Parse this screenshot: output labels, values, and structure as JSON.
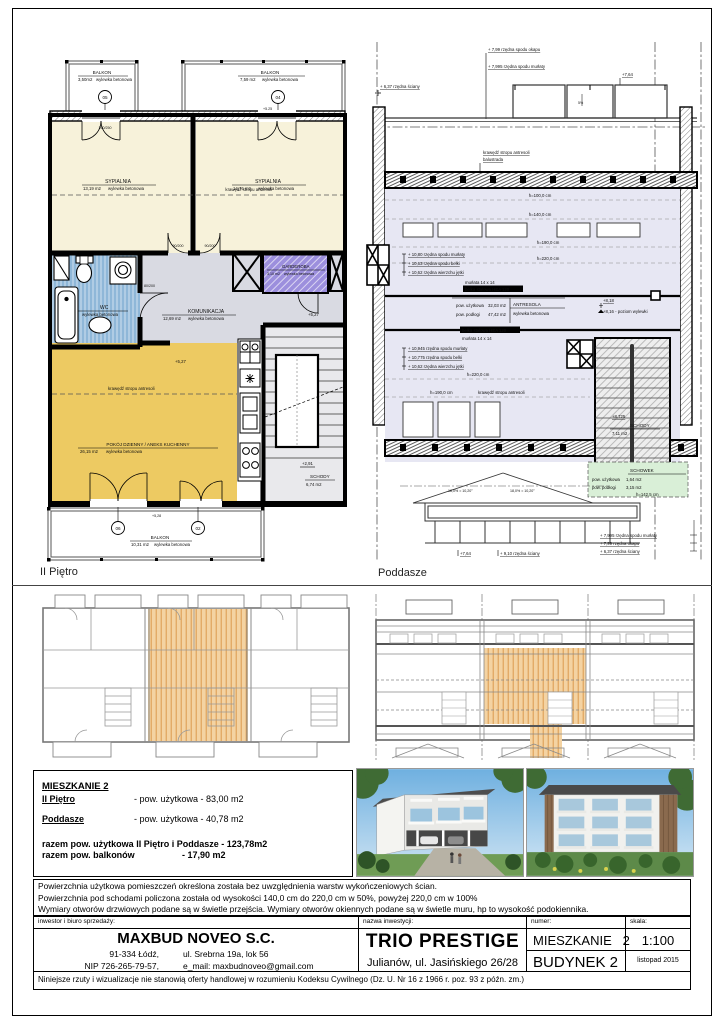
{
  "plans": {
    "left_title": "II Piętro",
    "right_title": "Poddasze"
  },
  "floor2": {
    "balkon05": {
      "name": "BALKON",
      "area": "3,50m2",
      "finish": "wylewka betonowa",
      "mark": "05"
    },
    "balkon04": {
      "name": "BALKON",
      "area": "7,59 m2",
      "finish": "wylewka betonowa",
      "mark": "04"
    },
    "sypialnia_l": {
      "name": "SYPIALNIA",
      "area": "13,19 m2",
      "finish": "wylewka betonowa"
    },
    "sypialnia_p": {
      "name": "SYPIALNIA",
      "area": "14,76 m2",
      "finish": "wylewka betonowa"
    },
    "wc": {
      "name": "WC",
      "area": "6,37 m2",
      "finish": "wylewka betonowa"
    },
    "komunikacja": {
      "name": "KOMUNIKACJA",
      "area": "12,69 m2",
      "finish": "wylewka betonowa"
    },
    "garderoba": {
      "name": "GARDEROBA",
      "area": "3,10 m2",
      "finish": "wylewka betonowa"
    },
    "pokoj": {
      "name": "POKÓJ DZIENNY / ANEKS KUCHENNY",
      "area": "26,15 m2",
      "finish": "wylewka betonowa"
    },
    "schody": {
      "name": "SCHODY",
      "area": "6,74 m2"
    },
    "balkon_dol": {
      "name": "BALKON",
      "area": "10,31 m2",
      "finish": "wylewka betonowa",
      "mark1": "06",
      "mark2": "02"
    },
    "level_527": "+5,27",
    "level_291": "+2,91",
    "level_525": "+5,25",
    "level_528": "+5,28",
    "edge_note": "krawędź stropu antresoli",
    "dim_wc_door": "80/200",
    "dim_bed_door": "90/200",
    "dim_window": "160/250"
  },
  "attic": {
    "wall_637": "+ 6,37 rzędna ściany",
    "okap_799": "+ 7,99 rzędna spodu okapu",
    "murlata_7995": "+ 7,995  rzędna  spodu murłaty",
    "level_764": "+7,64",
    "slope_5": "5%",
    "edge_note": "krawędź stropu antresoli",
    "balustrada": "balustrada",
    "h100": "h=100,0 cm",
    "h140": "h=140,0 cm",
    "h190": "h=190,0 cm",
    "h220": "h=220,0 cm",
    "murlata_1080": "+ 10,80  rzędna spodu murłaty",
    "belka_1063": "+ 10,63  rzędna spodu belki",
    "jetka_1062": "+ 10,62  rzędna wierzchu jętki",
    "murlata_14": "murłata 14 x 14",
    "belka_hea": "belka stalowa HEA 120",
    "antresola": {
      "name": "ANTRESOLA",
      "usable_label": "pow. użytkowa",
      "usable": "32,03 m2",
      "floor_label": "pow. podłogi",
      "floor": "47,42 m2",
      "finish": "wylewka betonowa"
    },
    "level_818": "+8,18",
    "level_816": "+8,16 - poziom wylewki",
    "murlata_10945": "+ 10,945  rzędna spodu murłaty",
    "belka_10775": "+ 10,775  rzędna spodu belki",
    "h190_edge": "krawędź stropu antresoli",
    "level_8725": "+8,725",
    "schody": {
      "name": "SCHODY",
      "area": "7,11 m2"
    },
    "schowek": {
      "name": "SCHOWEK",
      "usable_label": "pow. użytkowa",
      "usable": "1,64 m2",
      "floor_label": "pow. podłogi",
      "floor": "3,15 m2",
      "h": "h=142,5 cm"
    },
    "roof_slope": "18,0% = 10,20°",
    "level_764b": "+7,64",
    "wall_910": "+ 9,10 rzędna ściany",
    "murlata_7995b": "+ 7,995  rzędna  spodu murłaty",
    "okap_799b": "+ 7,99 rzędna okapu",
    "wall_637b": "+ 6,37 rzędna ściany"
  },
  "info": {
    "title": "MIESZKANIE 2",
    "row1_label": "II Piętro",
    "row1_value": "- pow. użytkowa - 83,00 m2",
    "row2_label": "Poddasze",
    "row2_value": "- pow. użytkowa - 40,78 m2",
    "total1": "razem pow. użytkowa II Piętro i Poddasze - 123,78m2",
    "total2_label": "razem pow. balkonów",
    "total2_value": "- 17,90 m2"
  },
  "notes": {
    "line1": "Powierzchnia użytkowa pomieszczeń określona została bez uwzględnienia warstw wykończeniowych ścian.",
    "line2": "Powierzchnia pod schodami policzona została od wysokości 140,0 cm do 220,0 cm w 50%, powyżej 220,0 cm w 100%",
    "line3": "Wymiary otworów drzwiowych podane są w świetle przejścia. Wymiary otworów okiennych podane są w świetle muru, hp to wysokość podokiennika."
  },
  "titleblock": {
    "investor_label": "inwestor i biuro sprzedaży:",
    "company": "MAXBUD NOVEO S.C.",
    "addr_city": "91-334 Łódź,",
    "addr_street": "ul. Srebrna 19a, lok 56",
    "nip": "NIP 726-265-79-57,",
    "email": "e_mail: maxbudnoveo@gmail.com",
    "project_label": "nazwa inwestycji:",
    "project": "TRIO PRESTIGE",
    "project_addr": "Julianów, ul. Jasińskiego 26/28",
    "number_label": "numer:",
    "apartment": "MIESZKANIE   2",
    "building": "BUDYNEK 2",
    "scale_label": "skala:",
    "scale": "1:100",
    "date": "listopad 2015"
  },
  "footer": "Niniejsze rzuty i wizualizacje nie stanowią oferty handlowej w rozumieniu Kodeksu Cywilnego (Dz. U. Nr 16 z 1966 r. poz. 93 z późn. zm.)",
  "colors": {
    "bedroom": "#f7f2da",
    "wc": "#8fb7d8",
    "hall": "#d9dae2",
    "wardrobe": "#9c8fdd",
    "living": "#edca62",
    "stairs": "#e9e9ec",
    "attic_room": "#e7e7f3",
    "schowek": "#d9efd7",
    "highlight": "#f0c184",
    "sky": "#76b3e2"
  }
}
